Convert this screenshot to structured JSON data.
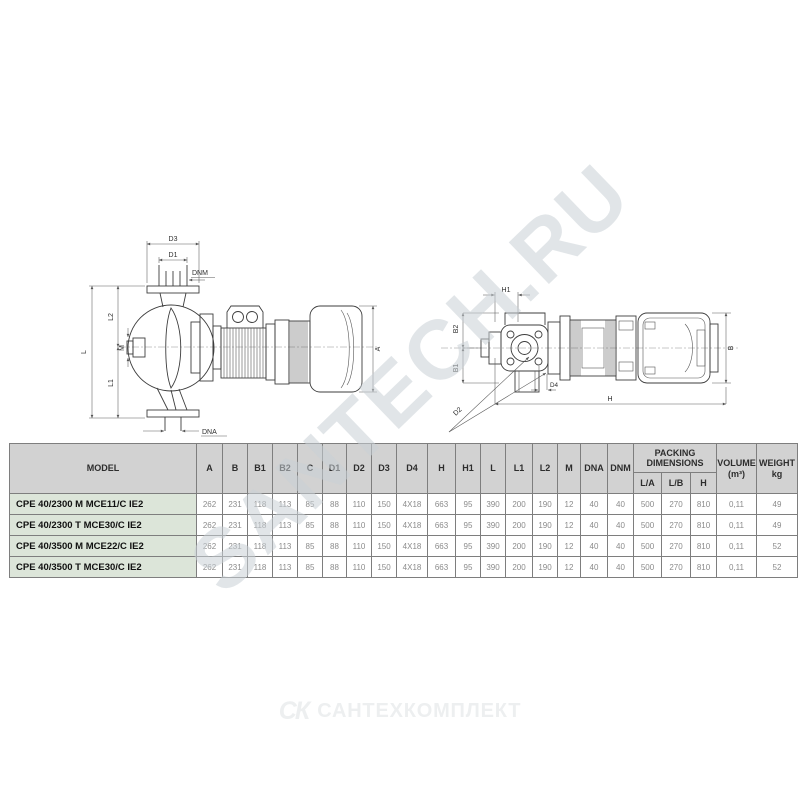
{
  "watermark": "SANTECH.RU",
  "footer": {
    "monogram": "СК",
    "brand": "САНТЕХКОМПЛЕКТ"
  },
  "diagrams": {
    "side": {
      "d3": "D3",
      "d1": "D1",
      "dnm": "DNM",
      "l": "L",
      "l2": "L2",
      "l1": "L1",
      "m": "M",
      "a": "A",
      "dna": "DNA"
    },
    "top": {
      "h1": "H1",
      "b2": "B2",
      "b1": "B1",
      "d2": "D2",
      "d4": "D4",
      "h": "H",
      "b": "B"
    }
  },
  "table": {
    "header": {
      "model": "MODEL",
      "dims": [
        "A",
        "B",
        "B1",
        "B2",
        "C",
        "D1",
        "D2",
        "D3",
        "D4",
        "H",
        "H1",
        "L",
        "L1",
        "L2",
        "M",
        "DNA",
        "DNM"
      ],
      "packing_title": "PACKING DIMENSIONS",
      "packing_sub": [
        "L/A",
        "L/B",
        "H"
      ],
      "volume_line1": "VOLUME",
      "volume_line2": "(m³)",
      "weight_line1": "WEIGHT",
      "weight_line2": "kg"
    },
    "rows": [
      {
        "model": "CPE 40/2300 M MCE11/C IE2",
        "values": [
          "262",
          "231",
          "118",
          "113",
          "85",
          "88",
          "110",
          "150",
          "4X18",
          "663",
          "95",
          "390",
          "200",
          "190",
          "12",
          "40",
          "40",
          "500",
          "270",
          "810",
          "0,11",
          "49"
        ]
      },
      {
        "model": "CPE 40/2300 T MCE30/C IE2",
        "values": [
          "262",
          "231",
          "118",
          "113",
          "85",
          "88",
          "110",
          "150",
          "4X18",
          "663",
          "95",
          "390",
          "200",
          "190",
          "12",
          "40",
          "40",
          "500",
          "270",
          "810",
          "0,11",
          "49"
        ]
      },
      {
        "model": "CPE 40/3500 M MCE22/C IE2",
        "values": [
          "262",
          "231",
          "118",
          "113",
          "85",
          "88",
          "110",
          "150",
          "4X18",
          "663",
          "95",
          "390",
          "200",
          "190",
          "12",
          "40",
          "40",
          "500",
          "270",
          "810",
          "0,11",
          "52"
        ]
      },
      {
        "model": "CPE 40/3500 T MCE30/C IE2",
        "values": [
          "262",
          "231",
          "118",
          "113",
          "85",
          "88",
          "110",
          "150",
          "4X18",
          "663",
          "95",
          "390",
          "200",
          "190",
          "12",
          "40",
          "40",
          "500",
          "270",
          "810",
          "0,11",
          "52"
        ]
      }
    ]
  }
}
